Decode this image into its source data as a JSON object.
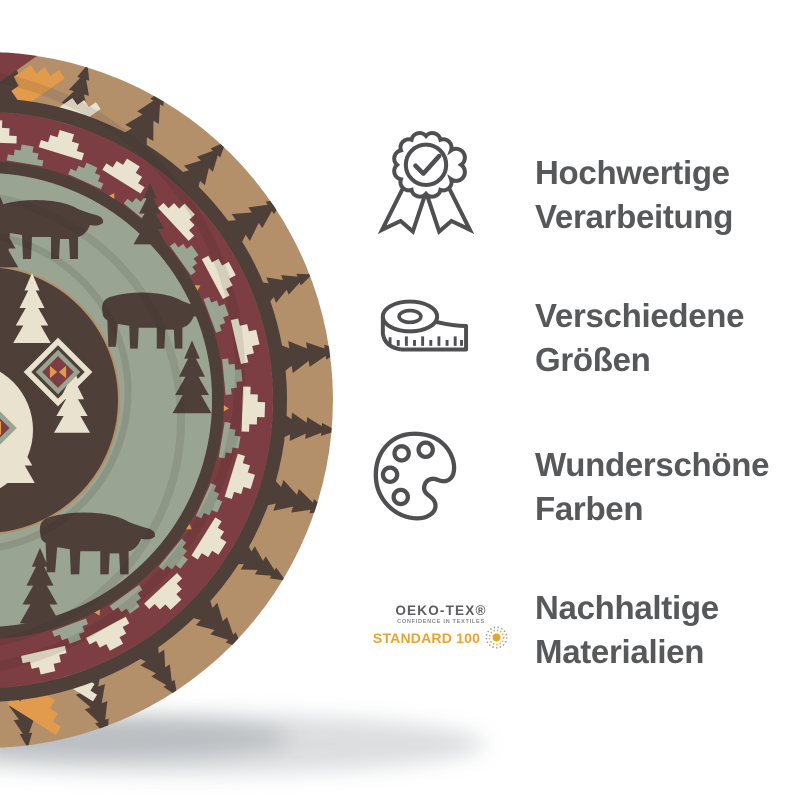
{
  "page": {
    "background": "#FFFFFF"
  },
  "product_image": {
    "name": "rolled-blanket-photo",
    "icon": "rolled-aztec-bear-blanket",
    "colors": {
      "tan": "#B3906A",
      "dark_brown": "#4E4039",
      "maroon": "#7C3E42",
      "sage_green": "#9AA492",
      "cream": "#E9E2CE",
      "orange": "#E29B4C"
    }
  },
  "features": [
    {
      "icon": "award-badge-icon",
      "line1": "Hochwertige",
      "line2": "Verarbeitung"
    },
    {
      "icon": "measuring-tape-icon",
      "line1": "Verschiedene",
      "line2": "Größen"
    },
    {
      "icon": "paint-palette-icon",
      "line1": "Wunderschöne",
      "line2": "Farben"
    },
    {
      "icon": "oeko-tex-standard-100-logo",
      "line1": "Nachhaltige",
      "line2": "Materialien"
    }
  ],
  "oeko_tex_logo": {
    "brand": "OEKO-TEX®",
    "tagline": "CONFIDENCE IN TEXTILES",
    "standard": "STANDARD 100",
    "flower_icon": "dotted-flower-icon",
    "orange": "#E9A42B"
  },
  "style": {
    "text_color": "#57585A",
    "icon_stroke": "#4F4F51"
  }
}
